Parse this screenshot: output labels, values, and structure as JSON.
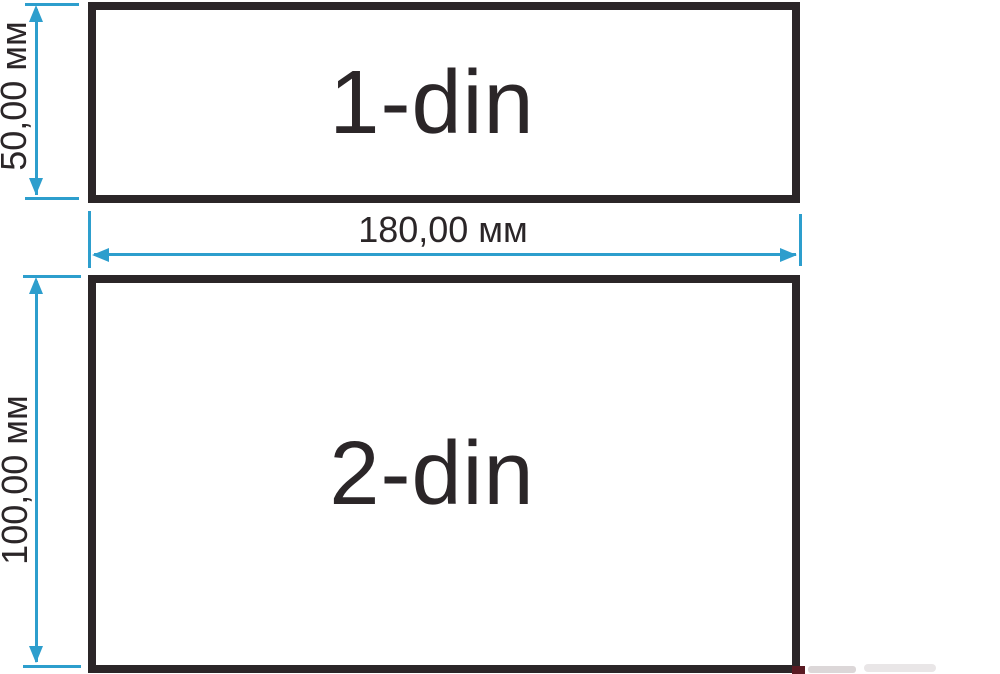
{
  "colors": {
    "accent_dimension": "#2d9ecd",
    "ink": "#2b2628",
    "background": "#ffffff",
    "watermark_red": "#591a22"
  },
  "boxes": [
    {
      "label": "1-din"
    },
    {
      "label": "2-din"
    }
  ],
  "dimensions": {
    "din1_height": {
      "label": "50,00 мм",
      "orientation": "vertical"
    },
    "shared_width": {
      "label": "180,00 мм",
      "orientation": "horizontal"
    },
    "din2_height": {
      "label": "100,00 мм",
      "orientation": "vertical"
    }
  }
}
